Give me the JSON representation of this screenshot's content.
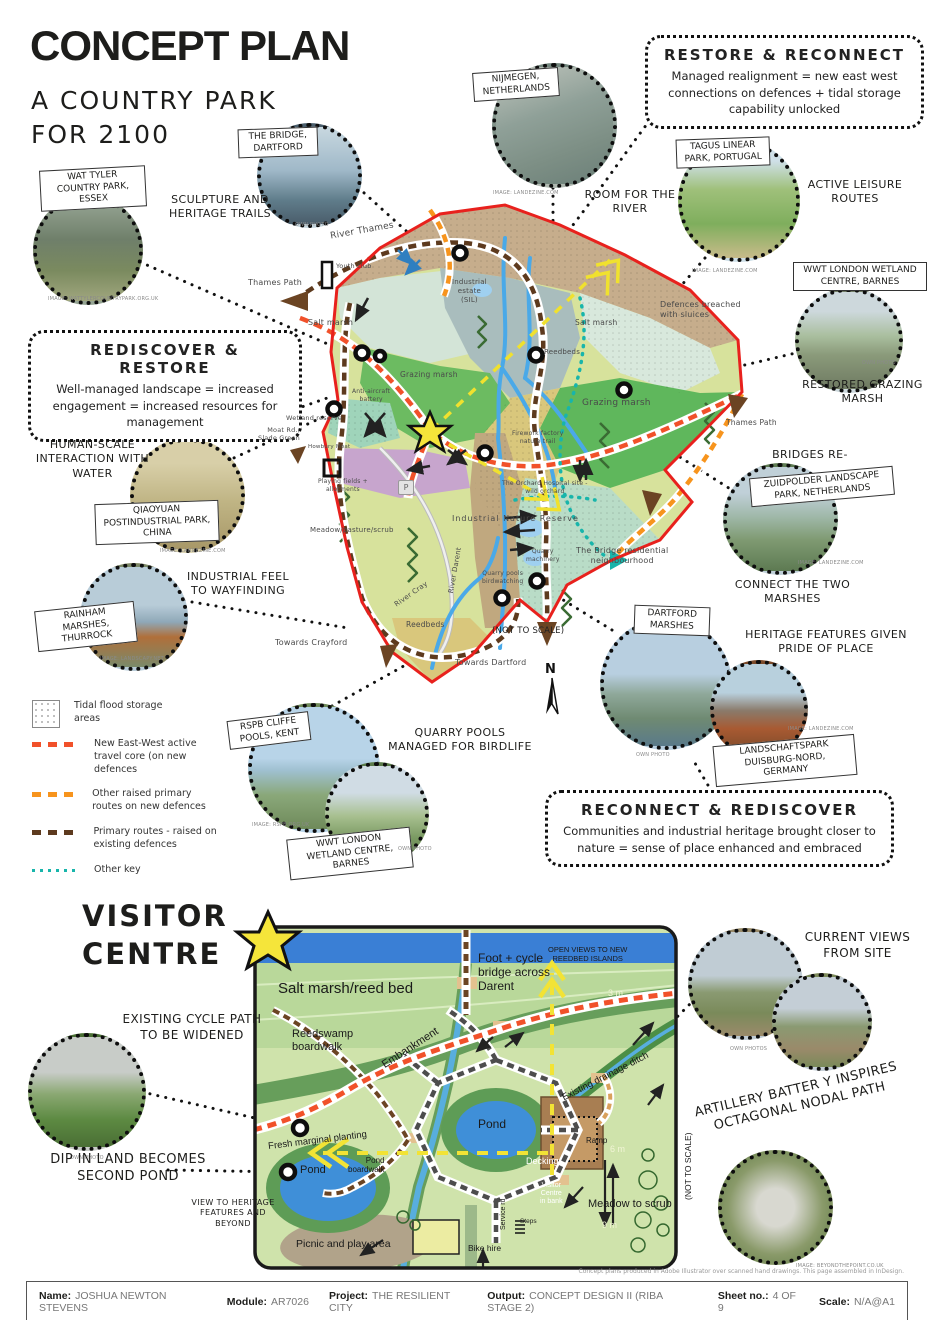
{
  "header": {
    "title": "CONCEPT PLAN",
    "subtitle_line1": "A COUNTRY PARK",
    "subtitle_line2": "FOR 2100"
  },
  "concept_boxes": {
    "restore_reconnect": {
      "title": "RESTORE & RECONNECT",
      "body": "Managed realignment = new east west connections on defences + tidal storage capability unlocked"
    },
    "rediscover_restore": {
      "title": "REDISCOVER & RESTORE",
      "body": "Well-managed landscape = increased engagement = increased resources for management"
    },
    "reconnect_rediscover": {
      "title": "RECONNECT & REDISCOVER",
      "body": "Communities and industrial heritage brought closer to nature = sense of place enhanced and embraced"
    }
  },
  "precedents": {
    "wat_tyler": {
      "label": "WAT TYLER COUNTRY PARK, ESSEX",
      "credit": "IMAGE: WATTYLERCOUNTRYPARK.ORG.UK"
    },
    "the_bridge": {
      "label": "THE BRIDGE, DARTFORD",
      "credit": "OWN PHOTO"
    },
    "nijmegen": {
      "label": "NIJMEGEN, NETHERLANDS",
      "credit": "IMAGE: LANDEZINE.COM"
    },
    "tagus": {
      "label": "TAGUS LINEAR PARK, PORTUGAL",
      "credit": "IMAGE: LANDEZINE.COM"
    },
    "wwt_barnes_right": {
      "label": "WWT LONDON WETLAND CENTRE, BARNES",
      "credit": "OWN PHOTO"
    },
    "qiaoyuan": {
      "label": "QIAOYUAN POSTINDUSTRIAL PARK, CHINA",
      "credit": "IMAGE: LANDEZINE.COM"
    },
    "rainham": {
      "label": "RAINHAM MARSHES, THURROCK",
      "credit": "IMAGE: LANDSCAPY.NET"
    },
    "zuidpolder": {
      "label": "ZUIDPOLDER LANDSCAPE PARK, NETHERLANDS",
      "credit": "IMAGE: LANDEZINE.COM"
    },
    "dartford_marshes": {
      "label": "DARTFORD MARSHES",
      "credit": "OWN PHOTO"
    },
    "duisburg": {
      "label": "LANDSCHAFTSPARK DUISBURG-NORD, GERMANY",
      "credit": "IMAGE: LANDEZINE.COM"
    },
    "rspb_cliffe": {
      "label": "RSPB CLIFFE POOLS, KENT",
      "credit": "IMAGE: RSPB.ORG.UK"
    },
    "wwt_barnes_bottom": {
      "label": "WWT LONDON WETLAND CENTRE, BARNES",
      "credit": "OWN PHOTO"
    },
    "cycle_path": {
      "credit": "OWN PHOTO"
    },
    "current_views": {
      "credit": "OWN PHOTOS"
    },
    "artillery": {
      "credit": "IMAGE: BEYONDTHEPOINT.CO.UK"
    }
  },
  "annotations": {
    "sculpture": "SCULPTURE AND HERITAGE TRAILS",
    "room_river": "ROOM FOR THE RIVER",
    "active_leisure": "ACTIVE LEISURE ROUTES",
    "restored_marsh": "RESTORED GRAZING MARSH",
    "human_scale": "HUMAN-SCALE INTERACTION WITH WATER",
    "bridges_re": "BRIDGES RE-",
    "connect_marshes": "CONNECT THE TWO MARSHES",
    "industrial_wayfinding": "INDUSTRIAL FEEL TO WAYFINDING",
    "heritage_pride": "HERITAGE FEATURES GIVEN PRIDE OF PLACE",
    "quarry_pools": "QUARRY POOLS MANAGED FOR BIRDLIFE",
    "current_views": "CURRENT VIEWS FROM SITE",
    "artillery": "ARTILLERY BATTER Y INSPIRES OCTAGONAL NODAL PATH",
    "cycle_widened": "EXISTING CYCLE PATH TO BE WIDENED",
    "dip_pond": "DIP IN LAND BECOMES SECOND POND",
    "view_heritage": "VIEW TO HERITAGE FEATURES AND BEYOND"
  },
  "legend": {
    "items": [
      {
        "label": "Tidal flood storage areas",
        "color": "#bbbbbb"
      },
      {
        "label": "New East-West active travel core (on new defences",
        "color": "#f1512a"
      },
      {
        "label": "Other raised primary routes on new defences",
        "color": "#f7941d"
      },
      {
        "label": "Primary routes - raised on existing defences",
        "color": "#5d3a1e"
      },
      {
        "label": "Other key",
        "color": "#18b5ab"
      }
    ]
  },
  "main_map": {
    "labels": {
      "river_thames": "River Thames",
      "thames_path_left": "Thames Path",
      "youth_club": "Youth club",
      "salt_marsh_left": "Salt marsh",
      "anti_aircraft": "Anti-aircraft\nbattery",
      "grazing_marsh_left": "Grazing marsh",
      "industrial_estate": "Industrial\nestate\n(SIL)",
      "reedbeds_mid": "Reedbeds",
      "salt_marsh_right": "Salt marsh",
      "grazing_marsh_right": "Grazing marsh",
      "defences_breached": "Defences breached\nwith sluices",
      "thames_path_right": "Thames Path",
      "wetland_reserve": "Wetland reserve",
      "moat_rd": "Moat Rd.,\nSlade Green",
      "howbury_moat": "Howbury Moat",
      "playing_fields": "Playing fields +\nallotments",
      "parking": "P",
      "meadow": "Meadow/pasture/scrub",
      "firework_factory": "Firework factory\nnature trail",
      "orchard_hospital": "The Orchard Hospital site -\nwild orchard",
      "industrial_nature_reserve": "Industrial Nature Reserve",
      "quarry_machinery": "Quarry\nmachinery",
      "quarry_pools_bw": "Quarry pools\nbirdwatching",
      "bridge_residential": "The Bridge residential\nneighbourhood",
      "river_cray": "River Cray",
      "river_darent": "River Darent",
      "reedbeds_bottom": "Reedbeds",
      "towards_crayford": "Towards Crayford",
      "towards_dartford": "Towards Dartford"
    },
    "not_to_scale": "(NOT TO SCALE)",
    "compass": "N"
  },
  "visitor_centre": {
    "title_line1": "VISITOR",
    "title_line2": "CENTRE",
    "labels": {
      "salt_marsh": "Salt marsh/reed bed",
      "reedswamp": "Reedswamp\nboardwalk",
      "embankment": "Embankment",
      "foot_cycle": "Foot + cycle\nbridge across\nDarent",
      "open_views": "OPEN VIEWS TO NEW\nREEDBED ISLANDS",
      "m3": "3 m",
      "drainage": "Existing drainage ditch",
      "fresh_marginal": "Fresh marginal planting",
      "pond_left": "Pond",
      "pond_boardwalk": "Pond\nboardwalk",
      "pond_centre": "Pond",
      "decking": "Decking",
      "visitor_centre_in_bank": "Visitor\nCentre\nin bank",
      "ramp": "Ramp",
      "m6": "6 m",
      "meadow_scrub": "Meadow to scrub",
      "m9": "9 m",
      "picnic": "Picnic and play area",
      "bike_hire": "Bike hire",
      "service_rd": "Service rd",
      "steps": "Steps",
      "not_to_scale": "(NOT TO SCALE)"
    }
  },
  "footer": {
    "credit_line": "Concept plans produced in Adobe Illustrator over scanned hand drawings. This page assembled in InDesign.",
    "fields": [
      {
        "label": "Name:",
        "value": "JOSHUA NEWTON STEVENS"
      },
      {
        "label": "Module:",
        "value": "AR7026"
      },
      {
        "label": "Project:",
        "value": "THE RESILIENT CITY"
      },
      {
        "label": "Output:",
        "value": "CONCEPT DESIGN II (RIBA STAGE 2)"
      },
      {
        "label": "Sheet no.:",
        "value": "4 OF 9"
      },
      {
        "label": "Scale:",
        "value": "N/A@A1"
      }
    ]
  },
  "colors": {
    "boundary_red": "#e8211d",
    "route_red": "#f1512a",
    "route_orange": "#f7941d",
    "route_brown": "#5d3a1e",
    "route_teal": "#18b5ab",
    "route_yellow": "#f0e12e",
    "water_blue": "#4aa9e8",
    "star_yellow": "#f5e53a"
  }
}
